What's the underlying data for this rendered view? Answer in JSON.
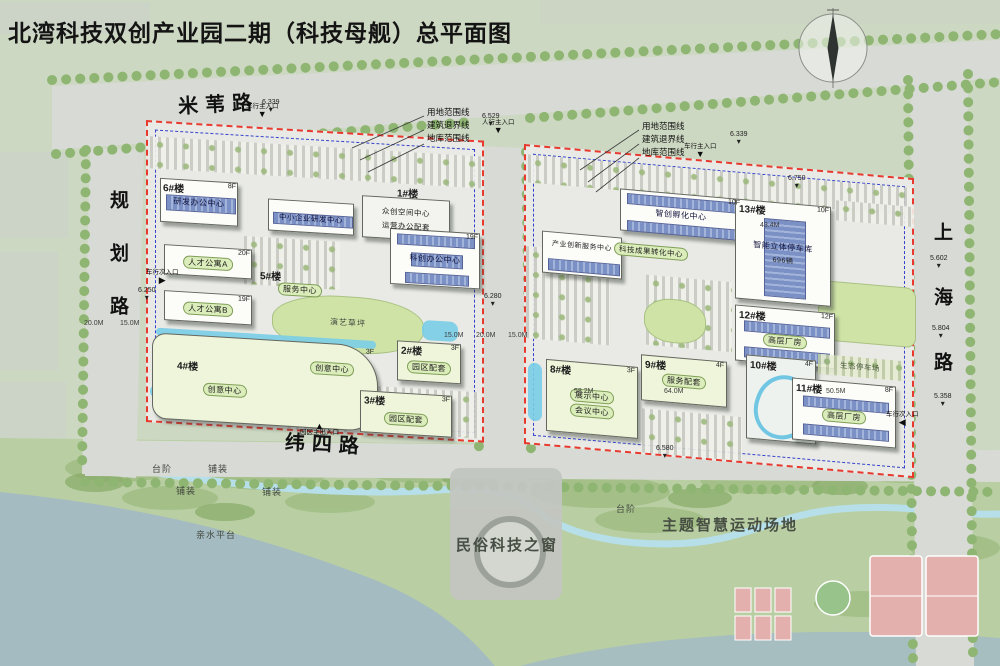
{
  "title": "北湾科技双创产业园二期（科技母舰）总平面图",
  "roads": {
    "top": "米苇路",
    "left": "规划路",
    "right": "上海路",
    "bottom": "纬四路"
  },
  "boundary_legend": {
    "site": "用地范围线",
    "setback": "建筑退界线",
    "basement": "地库范围线"
  },
  "parcel_west": {
    "b6": {
      "id": "6#楼",
      "name": "研发办公中心",
      "floors": "8F"
    },
    "sme": {
      "name": "中小企业研发中心"
    },
    "b1": {
      "id": "1#楼",
      "name": "众创空间中心",
      "name2": "运营办公配套"
    },
    "kc": {
      "name": "科创办公中心",
      "floors": "19F"
    },
    "b5": {
      "id": "5#楼",
      "name": "服务中心"
    },
    "aptA": {
      "name": "人才公寓A",
      "floors": "20F"
    },
    "aptB": {
      "name": "人才公寓B",
      "floors": "19F"
    },
    "b4": {
      "id": "4#楼",
      "name": "创意中心",
      "floors": "3F"
    },
    "b4b": {
      "name": "创意中心"
    },
    "b2": {
      "id": "2#楼",
      "name": "园区配套",
      "floors": "3F"
    },
    "b3": {
      "id": "3#楼",
      "name": "园区配套",
      "floors": "3F"
    },
    "lawn": "演艺草坪"
  },
  "parcel_east": {
    "svc": {
      "name": "产业创新服务中心"
    },
    "incubator": {
      "name": "智创孵化中心",
      "floors": "10F"
    },
    "transform": {
      "name": "科技成果转化中心"
    },
    "b13": {
      "id": "13#楼",
      "name": "智能立体停车库",
      "floors": "10F",
      "capacity": "696辆"
    },
    "b12": {
      "id": "12#楼",
      "name": "高层厂房",
      "floors": "12F"
    },
    "b8": {
      "id": "8#楼",
      "name": "展示中心",
      "name2": "会议中心",
      "floors": "3F"
    },
    "b9": {
      "id": "9#楼",
      "name": "服务配套",
      "floors": "4F"
    },
    "b10": {
      "id": "10#楼",
      "floors": "4F"
    },
    "b11": {
      "id": "11#楼",
      "name": "高层厂房",
      "floors": "8F"
    },
    "eco_parking": "生态停车场"
  },
  "landscape": {
    "window": "民俗科技之窗",
    "sports": "主题智慧运动场地",
    "waterfront": "亲水平台",
    "steps": "台阶",
    "paving": "铺装"
  },
  "markers": {
    "elevations": [
      "6.339",
      "6.529",
      "6.339",
      "6.250",
      "6.280",
      "6.580",
      "5.602",
      "5.804",
      "5.358",
      "6.750"
    ],
    "dimensions": [
      "20.0M",
      "15.0M",
      "15.0M",
      "20.0M",
      "15.0M",
      "58.2M",
      "64.0M",
      "50.5M",
      "43.4M"
    ],
    "entrances": [
      "车行主入口",
      "车行主入口",
      "车行次入口",
      "人行主入口",
      "园区主出入口",
      "车行次入口"
    ]
  },
  "colors": {
    "boundary_red": "#e8392f",
    "setback_blue": "#3342cc",
    "solar_blue": "#7b90c5",
    "lawn_green": "#cfe3a6",
    "tree_green": "#8fb573",
    "road_gray": "#d8dad5",
    "water": "#a4bbc2",
    "stream": "#b6dfe9",
    "court_pink": "#e4b0ad"
  }
}
